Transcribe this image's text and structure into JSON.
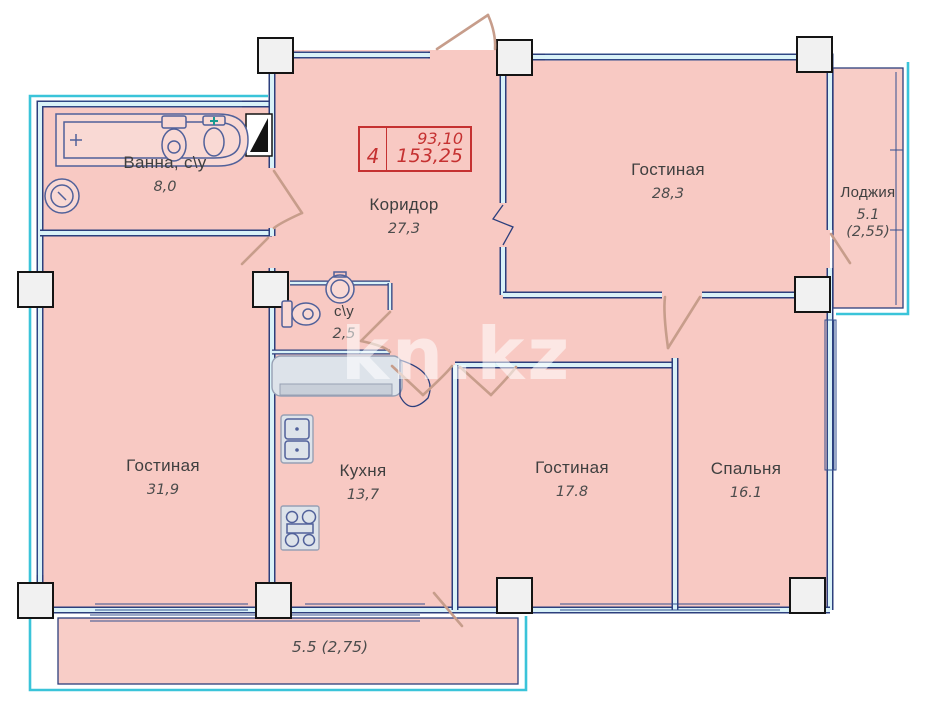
{
  "watermark": "kn.kz",
  "stamp": {
    "rooms_count": "4",
    "area_top": "93,10",
    "area_bottom": "153,25"
  },
  "rooms": [
    {
      "name": "Ванна, с\\у",
      "area": "8,0"
    },
    {
      "name": "Коридор",
      "area": "27,3"
    },
    {
      "name": "Гостиная",
      "area": "28,3"
    },
    {
      "name": "Лоджия",
      "area": "5.1",
      "area2": "(2,55)"
    },
    {
      "name": "Гостиная",
      "area": "31,9"
    },
    {
      "name": "с\\у",
      "area": "2,5"
    },
    {
      "name": "Кухня",
      "area": "13,7"
    },
    {
      "name": "Гостиная",
      "area": "17.8"
    },
    {
      "name": "Спальня",
      "area": "16.1"
    }
  ],
  "balcony": {
    "area": "5.5 (2,75)"
  },
  "colors": {
    "room_fill": "#f8c9c3",
    "wall_line": "#2c3f7d",
    "wall_fill": "#d9f2f8",
    "outer_line": "#3ac4d9",
    "stamp_red": "#c53131",
    "door_tan": "#c79d8b"
  }
}
